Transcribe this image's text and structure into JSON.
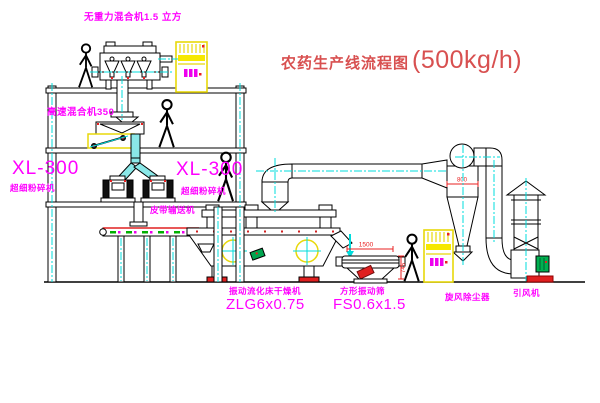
{
  "title": {
    "name": "农药生产线流程图",
    "capacity": "(500kg/h)"
  },
  "labels": {
    "gravity_mixer": "无重力混合机1.5 立方",
    "high_speed_mixer": "高速混合机350",
    "pulverizer_left_model": "XL-300",
    "pulverizer_left_name": "超细粉碎机",
    "pulverizer_right_model": "XL-300",
    "pulverizer_right_name": "超细粉碎机",
    "belt_conveyor": "皮带输送机",
    "dryer_name": "振动流化床干燥机",
    "dryer_model": "ZLG6x0.75",
    "sieve_name": "方形振动筛",
    "sieve_model": "FS0.6x1.5",
    "cyclone": "旋风除尘器",
    "fan": "引风机"
  },
  "dimensions": {
    "sieve_length": "1500",
    "sieve_height": "745",
    "cyclone_width": "800"
  },
  "colors": {
    "label_magenta": "#ff00ff",
    "title_red": "#d85050",
    "dimension_red": "#e82020",
    "centerline_cyan": "#00dcdc",
    "highlight_yellow": "#f2e400"
  }
}
